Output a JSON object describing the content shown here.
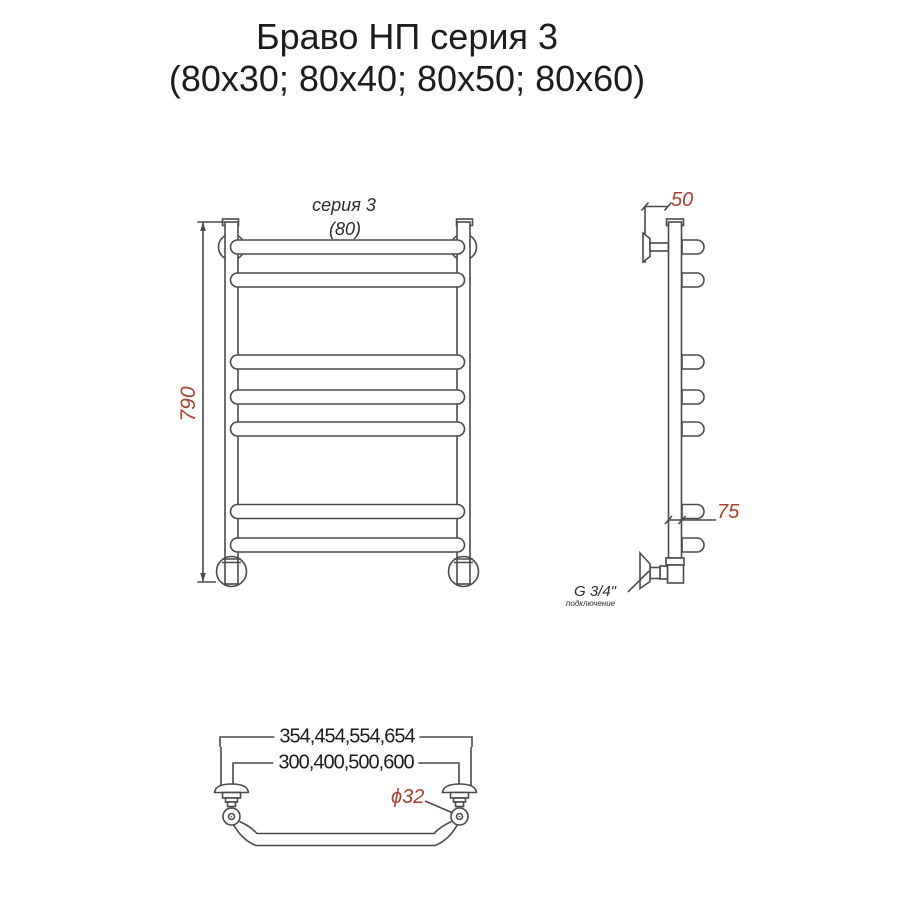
{
  "title": {
    "line1": "Браво НП серия 3",
    "line2": "(80x30; 80x40; 80x50; 80x60)"
  },
  "front_view": {
    "series_label": "серия 3",
    "width_label": "(80)",
    "height_dim": "790"
  },
  "side_view": {
    "depth_dim": "50",
    "bottom_spacing_dim": "75",
    "connection_size": "G 3/4\"",
    "connection_note": "подключение"
  },
  "bottom_view": {
    "outer_width_dim": "354,454,554,654",
    "inner_width_dim": "300,400,500,600",
    "tube_diameter": "ϕ32"
  },
  "colors": {
    "line": "#4a4a4a",
    "dimension_accent": "#a8402e",
    "text": "#1c1c1c",
    "background": "#ffffff"
  }
}
